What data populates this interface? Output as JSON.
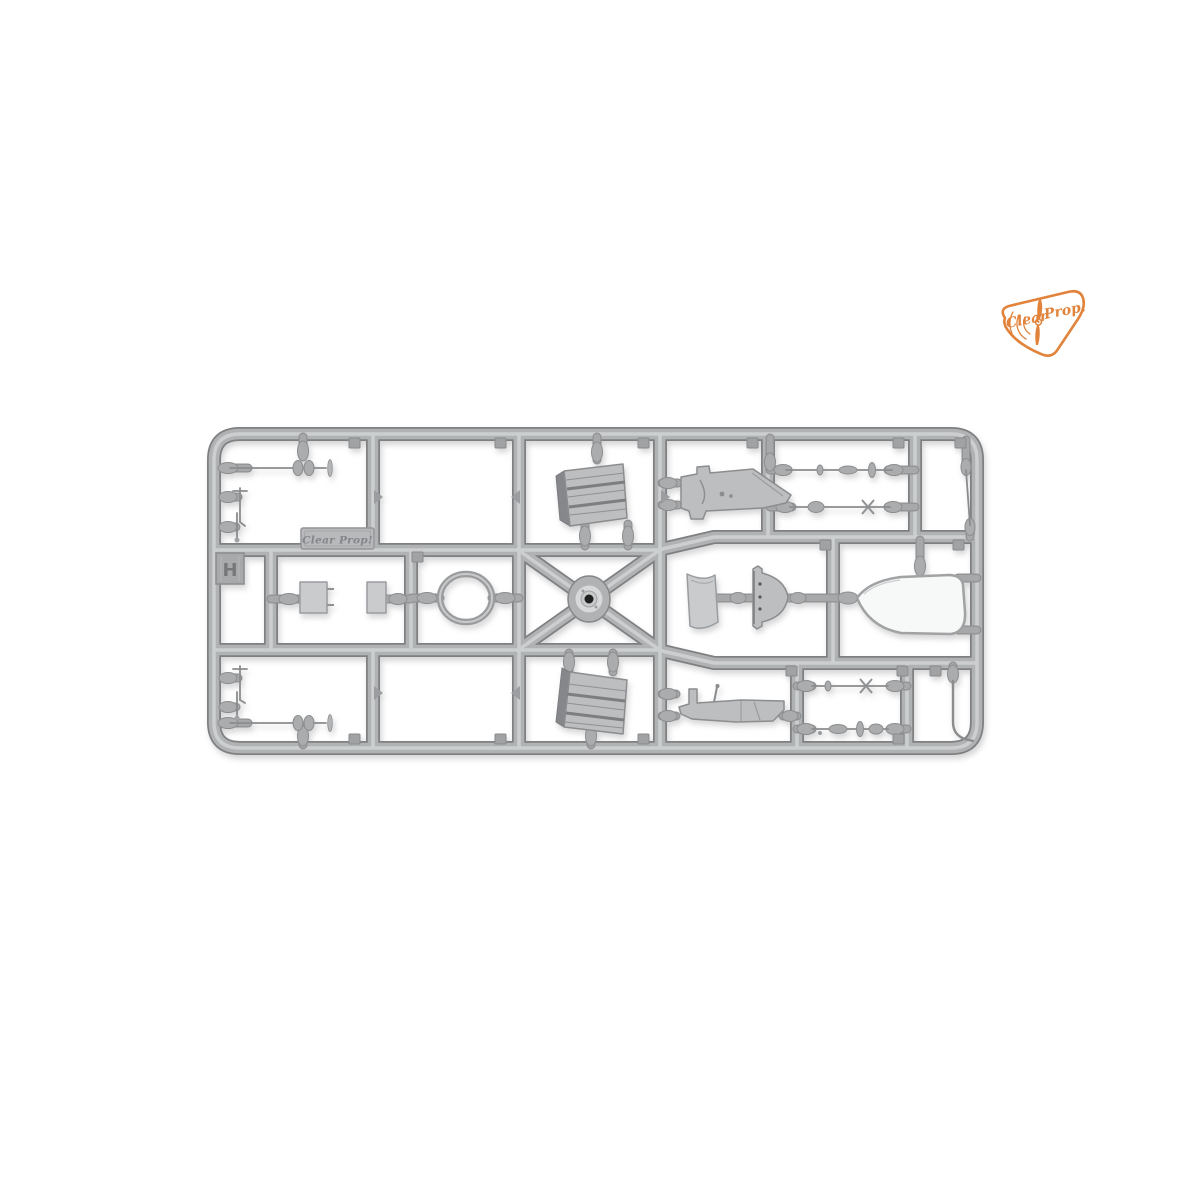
{
  "meta": {
    "subject": "gray injection-molded model kit sprue photographed on white background",
    "background": "#ffffff"
  },
  "theme": {
    "bg": "#ffffff",
    "plastic-mid": "#b0b2b4",
    "plastic-dark": "#8b8d8f",
    "plastic-deep": "#7e8082",
    "plastic-light": "#cfd1d3",
    "part-fill": "#bcbec0",
    "part-light": "#c9cbcd",
    "hole": "#1f1f1f",
    "brand-orange": "#e2833b",
    "emboss": "#83858a"
  },
  "logo": {
    "name": "clear-prop-logo",
    "word1": "Clear",
    "word2": "Prop!",
    "color": "#e2833b",
    "shape": "rounded triangular badge with propeller and radiating arcs"
  },
  "sprue": {
    "letter_tab": "H",
    "nameplate_text": "Clear Prop!",
    "plastic_color": "#b0b2b4",
    "parts": [
      {
        "id": "antenna-rod-top-left",
        "desc": "thin rod with twin-lobe hub and small blade"
      },
      {
        "id": "small-masts-top-left",
        "desc": "two small mast pieces on left edge"
      },
      {
        "id": "radiator-top",
        "desc": "ribbed trapezoid radiator block"
      },
      {
        "id": "gun-fairing-top",
        "desc": "flat angular fairing / receiver"
      },
      {
        "id": "barrel-rod-top-1",
        "desc": "thin barrel rod with collar and disc"
      },
      {
        "id": "barrel-rod-top-2",
        "desc": "thin barrel rod with cross fins"
      },
      {
        "id": "end-strut-top-right",
        "desc": "short strut with bullet ends"
      },
      {
        "id": "mount-plate-1",
        "desc": "small rectangular plate with pins"
      },
      {
        "id": "mount-plate-2",
        "desc": "small rectangular plate"
      },
      {
        "id": "cowl-ring",
        "desc": "oval ring"
      },
      {
        "id": "wheel-hub-center",
        "desc": "round hub with dark center hole on X-brace"
      },
      {
        "id": "curved-panel",
        "desc": "curved rectangular panel"
      },
      {
        "id": "headrest-fairing",
        "desc": "domed fairing with flat edge and holes"
      },
      {
        "id": "teardrop-fairing",
        "desc": "flat teardrop outline part"
      },
      {
        "id": "radiator-bottom",
        "desc": "ribbed trapezoid radiator block"
      },
      {
        "id": "cockpit-floor",
        "desc": "flat floor piece with upstands and control stick"
      },
      {
        "id": "barrel-rod-bottom-1",
        "desc": "thin rod with cross fins"
      },
      {
        "id": "barrel-rod-bottom-2",
        "desc": "stepped barrel rod"
      },
      {
        "id": "bent-tube-bottom-right",
        "desc": "bent tube"
      },
      {
        "id": "antenna-rod-bottom-left",
        "desc": "thin rod with twin-lobe hub and small blade"
      },
      {
        "id": "small-masts-bottom-left",
        "desc": "two small mast pieces on left edge"
      }
    ]
  }
}
